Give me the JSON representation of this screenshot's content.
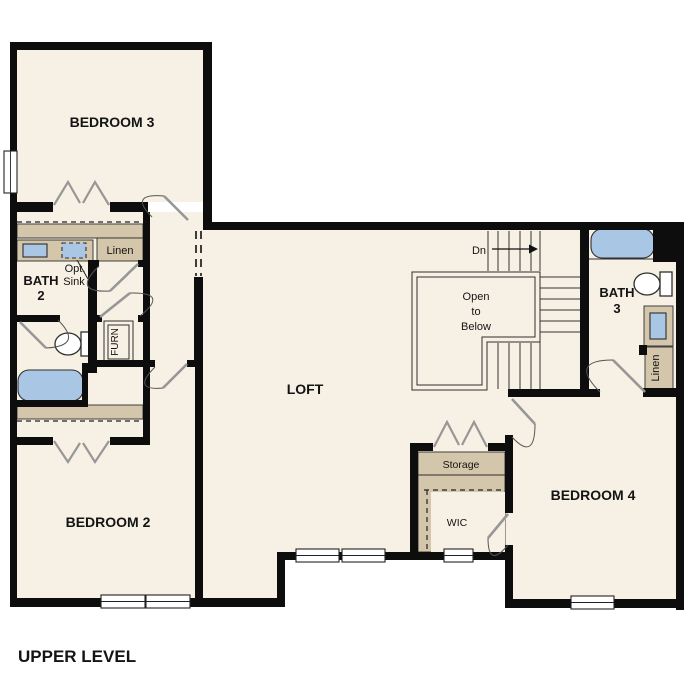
{
  "plan_title": "UPPER LEVEL",
  "colors": {
    "bg": "#ffffff",
    "floor": "#f7f0e4",
    "tan": "#d3c6aa",
    "fixture": "#a9c6e5",
    "wall": "#0d0d0d",
    "line": "#2f2f2f",
    "door": "#979797"
  },
  "rooms": {
    "bedroom3": "BEDROOM 3",
    "bedroom2": "BEDROOM 2",
    "bedroom4": "BEDROOM 4",
    "loft": "LOFT",
    "bath2": {
      "line1": "BATH",
      "line2": "2"
    },
    "bath3": {
      "line1": "BATH",
      "line2": "3"
    }
  },
  "labels": {
    "linen_left": "Linen",
    "linen_right": "Linen",
    "opt_sink": {
      "line1": "Opt.",
      "line2": "Sink"
    },
    "furnace": "FURN",
    "stairs_down": "Dn",
    "open_to_below": {
      "line1": "Open",
      "line2": "to",
      "line3": "Below"
    },
    "storage": "Storage",
    "wic": "WIC"
  }
}
